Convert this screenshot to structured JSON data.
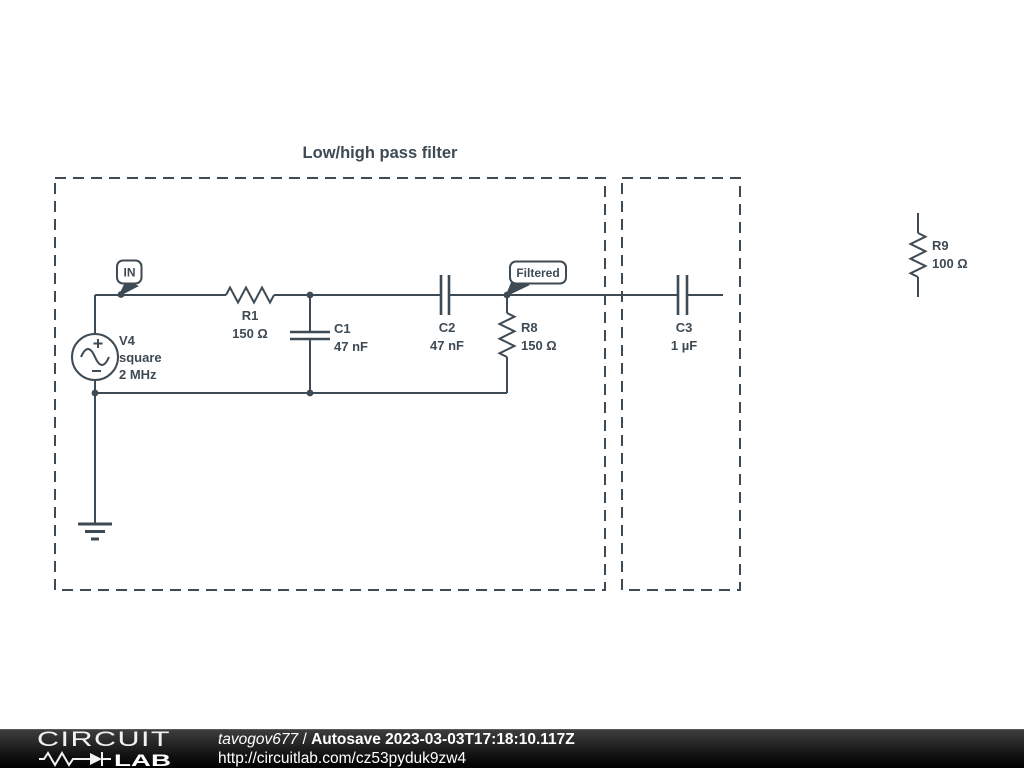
{
  "title": "Low/high pass filter",
  "colors": {
    "wire": "#3e4a54",
    "canvas_bg": "#ffffff",
    "footer_bg": "#000000",
    "footer_text": "#ffffff"
  },
  "flags": {
    "in": {
      "label": "IN"
    },
    "filtered": {
      "label": "Filtered"
    }
  },
  "components": {
    "v4": {
      "ref": "V4",
      "type": "square",
      "value": "2 MHz"
    },
    "r1": {
      "ref": "R1",
      "value": "150 Ω"
    },
    "c1": {
      "ref": "C1",
      "value": "47 nF"
    },
    "c2": {
      "ref": "C2",
      "value": "47 nF"
    },
    "r8": {
      "ref": "R8",
      "value": "150 Ω"
    },
    "c3": {
      "ref": "C3",
      "value": "1 µF"
    },
    "r9": {
      "ref": "R9",
      "value": "100 Ω"
    }
  },
  "footer": {
    "logo": {
      "circuit": "CIRCUIT",
      "lab": "LAB"
    },
    "author": "tavogov677",
    "separator": " / ",
    "save_label": "Autosave 2023-03-03T17:18:10.117Z",
    "url": "http://circuitlab.com/cz53pyduk9zw4"
  }
}
